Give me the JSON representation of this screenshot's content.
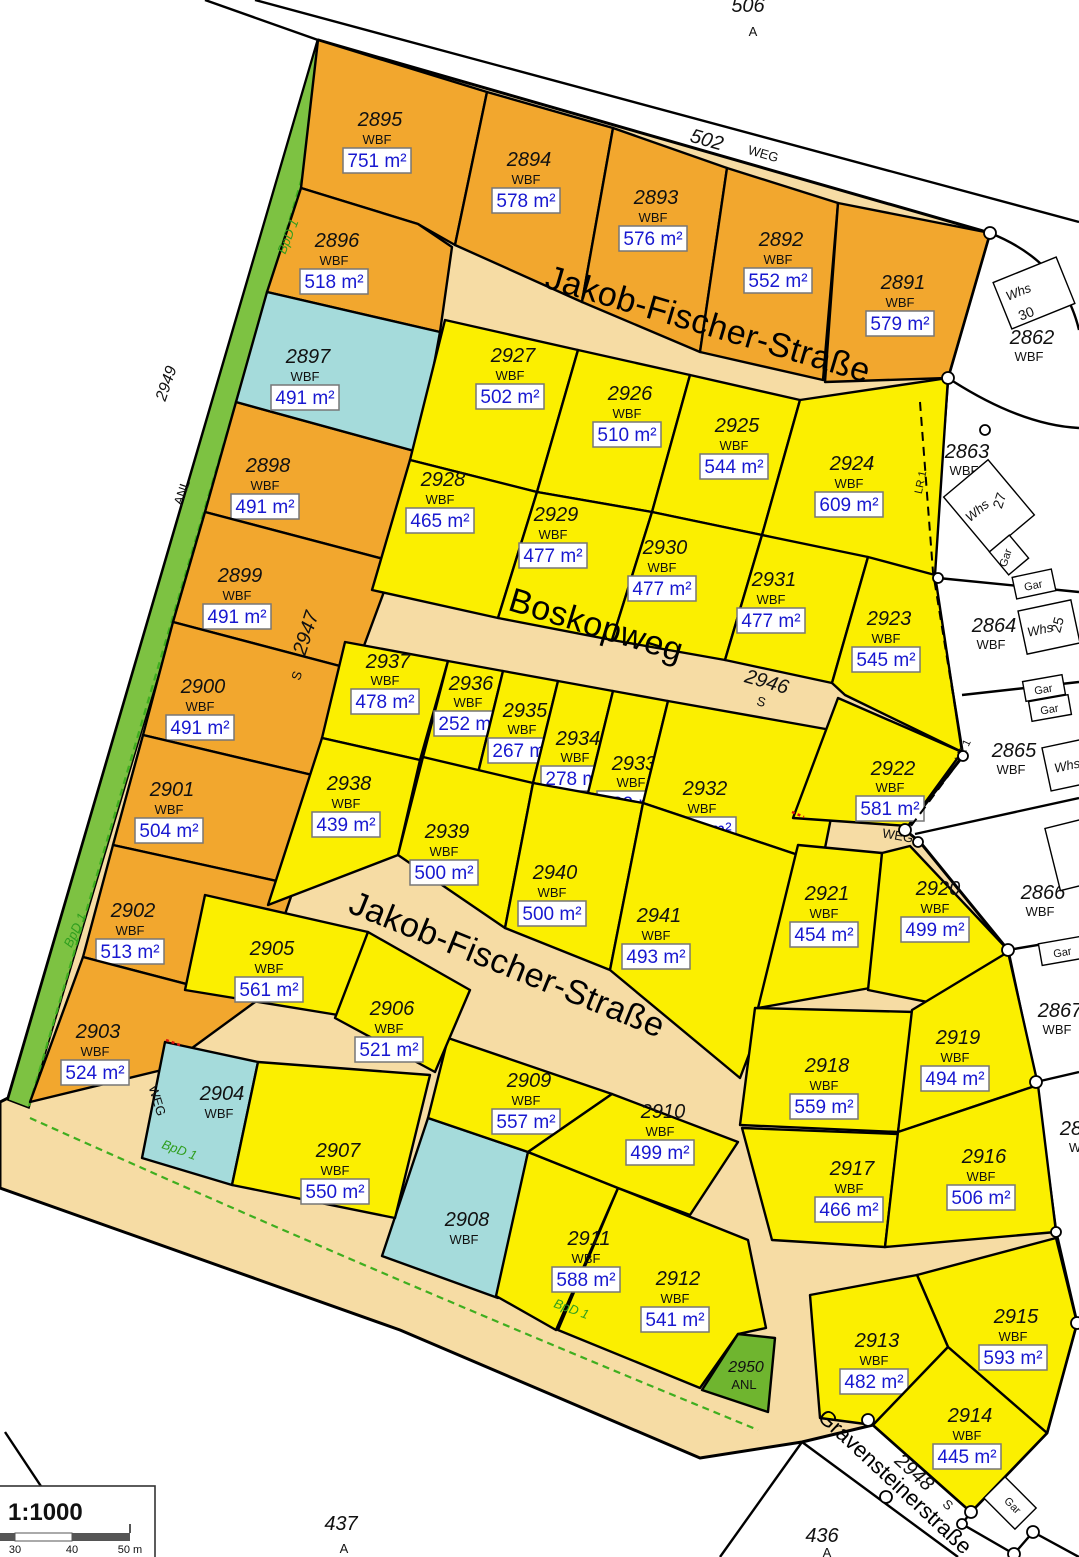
{
  "parcels": {
    "p2891": {
      "id": "2891",
      "use": "WBF",
      "area": "579 m²"
    },
    "p2892": {
      "id": "2892",
      "use": "WBF",
      "area": "552 m²"
    },
    "p2893": {
      "id": "2893",
      "use": "WBF",
      "area": "576 m²"
    },
    "p2894": {
      "id": "2894",
      "use": "WBF",
      "area": "578 m²"
    },
    "p2895": {
      "id": "2895",
      "use": "WBF",
      "area": "751 m²"
    },
    "p2896": {
      "id": "2896",
      "use": "WBF",
      "area": "518 m²"
    },
    "p2897": {
      "id": "2897",
      "use": "WBF",
      "area": "491 m²"
    },
    "p2898": {
      "id": "2898",
      "use": "WBF",
      "area": "491 m²"
    },
    "p2899": {
      "id": "2899",
      "use": "WBF",
      "area": "491 m²"
    },
    "p2900": {
      "id": "2900",
      "use": "WBF",
      "area": "491 m²"
    },
    "p2901": {
      "id": "2901",
      "use": "WBF",
      "area": "504 m²"
    },
    "p2902": {
      "id": "2902",
      "use": "WBF",
      "area": "513 m²"
    },
    "p2903": {
      "id": "2903",
      "use": "WBF",
      "area": "524 m²"
    },
    "p2904": {
      "id": "2904",
      "use": "WBF"
    },
    "p2905": {
      "id": "2905",
      "use": "WBF",
      "area": "561 m²"
    },
    "p2906": {
      "id": "2906",
      "use": "WBF",
      "area": "521 m²"
    },
    "p2907": {
      "id": "2907",
      "use": "WBF",
      "area": "550 m²"
    },
    "p2908": {
      "id": "2908",
      "use": "WBF"
    },
    "p2909": {
      "id": "2909",
      "use": "WBF",
      "area": "557 m²"
    },
    "p2910": {
      "id": "2910",
      "use": "WBF",
      "area": "499 m²"
    },
    "p2911": {
      "id": "2911",
      "use": "WBF",
      "area": "588 m²"
    },
    "p2912": {
      "id": "2912",
      "use": "WBF",
      "area": "541 m²"
    },
    "p2913": {
      "id": "2913",
      "use": "WBF",
      "area": "482 m²"
    },
    "p2914": {
      "id": "2914",
      "use": "WBF",
      "area": "445 m²"
    },
    "p2915": {
      "id": "2915",
      "use": "WBF",
      "area": "593 m²"
    },
    "p2916": {
      "id": "2916",
      "use": "WBF",
      "area": "506 m²"
    },
    "p2917": {
      "id": "2917",
      "use": "WBF",
      "area": "466 m²"
    },
    "p2918": {
      "id": "2918",
      "use": "WBF",
      "area": "559 m²"
    },
    "p2919": {
      "id": "2919",
      "use": "WBF",
      "area": "494 m²"
    },
    "p2920": {
      "id": "2920",
      "use": "WBF",
      "area": "499 m²"
    },
    "p2921": {
      "id": "2921",
      "use": "WBF",
      "area": "454 m²"
    },
    "p2922": {
      "id": "2922",
      "use": "WBF",
      "area": "581 m²"
    },
    "p2923": {
      "id": "2923",
      "use": "WBF",
      "area": "545 m²"
    },
    "p2924": {
      "id": "2924",
      "use": "WBF",
      "area": "609 m²"
    },
    "p2925": {
      "id": "2925",
      "use": "WBF",
      "area": "544 m²"
    },
    "p2926": {
      "id": "2926",
      "use": "WBF",
      "area": "510 m²"
    },
    "p2927": {
      "id": "2927",
      "use": "WBF",
      "area": "502 m²"
    },
    "p2928": {
      "id": "2928",
      "use": "WBF",
      "area": "465 m²"
    },
    "p2929": {
      "id": "2929",
      "use": "WBF",
      "area": "477 m²"
    },
    "p2930": {
      "id": "2930",
      "use": "WBF",
      "area": "477 m²"
    },
    "p2931": {
      "id": "2931",
      "use": "WBF",
      "area": "477 m²"
    },
    "p2932": {
      "id": "2932",
      "use": "WBF",
      "area": "463 m²"
    },
    "p2933": {
      "id": "2933",
      "use": "WBF",
      "area": "282 m²"
    },
    "p2934": {
      "id": "2934",
      "use": "WBF",
      "area": "278 m²"
    },
    "p2935": {
      "id": "2935",
      "use": "WBF",
      "area": "267 m²"
    },
    "p2936": {
      "id": "2936",
      "use": "WBF",
      "area": "252 m²"
    },
    "p2937": {
      "id": "2937",
      "use": "WBF",
      "area": "478 m²"
    },
    "p2938": {
      "id": "2938",
      "use": "WBF",
      "area": "439 m²"
    },
    "p2939": {
      "id": "2939",
      "use": "WBF",
      "area": "500 m²"
    },
    "p2940": {
      "id": "2940",
      "use": "WBF",
      "area": "500 m²"
    },
    "p2941": {
      "id": "2941",
      "use": "WBF",
      "area": "493 m²"
    },
    "p2950": {
      "id": "2950",
      "use": "ANL"
    }
  },
  "neighbors": {
    "p2862": {
      "id": "2862",
      "use": "WBF"
    },
    "p2863": {
      "id": "2863",
      "use": "WBF"
    },
    "p2864": {
      "id": "2864",
      "use": "WBF"
    },
    "p2865": {
      "id": "2865",
      "use": "WBF"
    },
    "p2866": {
      "id": "2866",
      "use": "WBF"
    },
    "p2867": {
      "id": "2867",
      "use": "WBF"
    },
    "p2868_partial": {
      "id": "28",
      "use": "W"
    },
    "n506": {
      "id": "506",
      "use": "A"
    },
    "n437": {
      "id": "437",
      "use": "A"
    },
    "n436": {
      "id": "436",
      "use": "A"
    }
  },
  "streets": {
    "jakob_fischer": "Jakob-Fischer-Straße",
    "boskopweg": "Boskopweg",
    "gravensteinerstrasse": "Gravensteinerstraße",
    "weg": "WEG",
    "s502": {
      "id": "502",
      "type": "WEG"
    },
    "s2946": {
      "id": "2946",
      "type": "S"
    },
    "s2947": {
      "id": "2947",
      "type": "S"
    },
    "s2948": {
      "id": "2948",
      "type": "S"
    },
    "s2949": {
      "id": "2949",
      "type": "ANL"
    }
  },
  "buildings": {
    "whs": "Whs",
    "gar": "Gar",
    "no30": "30",
    "no27": "27",
    "no25": "25"
  },
  "annotations": {
    "bpd1": "BpD 1",
    "lr1": "LR 1"
  },
  "legend": {
    "scale": "1:1000",
    "tick30": "30",
    "tick40": "40",
    "tick50": "50 m"
  },
  "colors": {
    "orange_parcel": "#F2A72E",
    "yellow_parcel": "#FBEF00",
    "cyan_parcel": "#A5DBDB",
    "green_area": "#7DC242",
    "road": "#F6DCA4",
    "area_text_blue": "#1818D0"
  }
}
